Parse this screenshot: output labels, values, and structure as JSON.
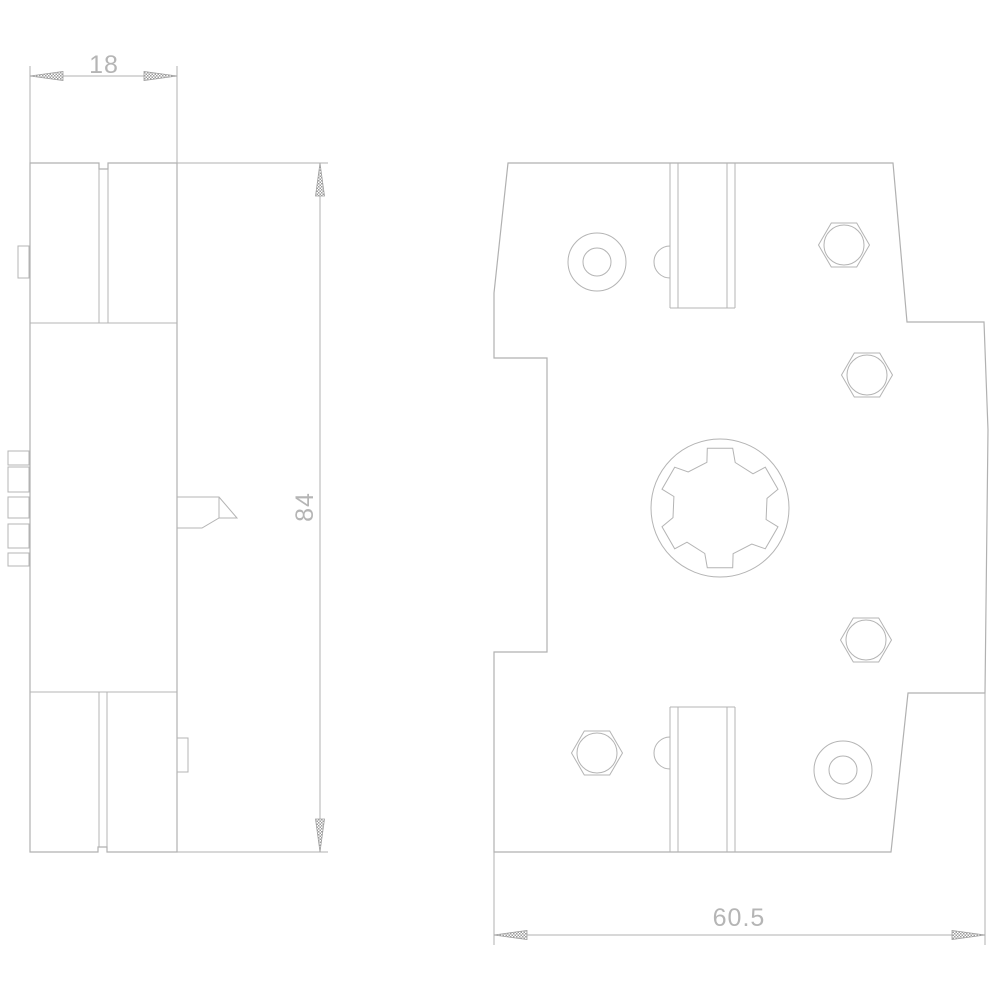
{
  "title": "Technical dimension drawing, side and front views",
  "style": {
    "background": "#ffffff",
    "line_color": "#b1b1b1",
    "text_color": "#b5b5b5"
  },
  "dimensions": {
    "top_width_mm": "18",
    "side_height_mm": "84",
    "bottom_width_mm": "60.5"
  }
}
